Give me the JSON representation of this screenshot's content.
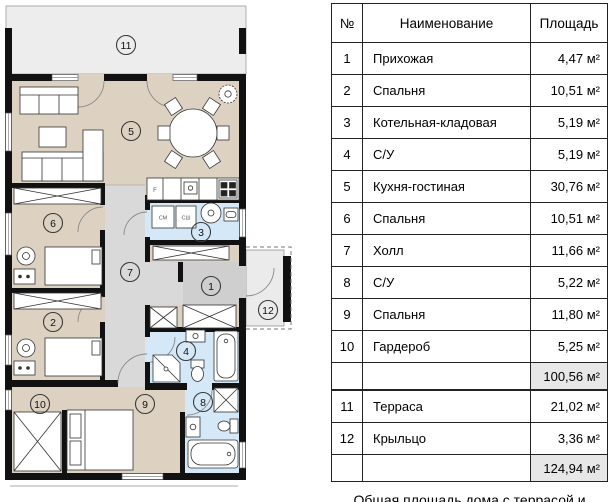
{
  "plan": {
    "room_numbers": {
      "r1": "1",
      "r2": "2",
      "r3": "3",
      "r4": "4",
      "r5": "5",
      "r6": "6",
      "r7": "7",
      "r8": "8",
      "r9": "9",
      "r10": "10",
      "r11": "11",
      "r12": "12"
    },
    "appliance_labels": {
      "fridge": "F",
      "washer": "СМ",
      "dryer": "СШ"
    }
  },
  "table": {
    "headers": {
      "num": "№",
      "name": "Наименование",
      "area": "Площадь"
    },
    "rows": [
      {
        "num": "1",
        "name": "Прихожая",
        "area": "4,47 м²"
      },
      {
        "num": "2",
        "name": "Спальня",
        "area": "10,51 м²"
      },
      {
        "num": "3",
        "name": "Котельная-кладовая",
        "area": "5,19 м²"
      },
      {
        "num": "4",
        "name": "С/У",
        "area": "5,19 м²"
      },
      {
        "num": "5",
        "name": "Кухня-гостиная",
        "area": "30,76 м²"
      },
      {
        "num": "6",
        "name": "Спальня",
        "area": "10,51 м²"
      },
      {
        "num": "7",
        "name": "Холл",
        "area": "11,66 м²"
      },
      {
        "num": "8",
        "name": "С/У",
        "area": "5,22 м²"
      },
      {
        "num": "9",
        "name": "Спальня",
        "area": "11,80 м²"
      },
      {
        "num": "10",
        "name": "Гардероб",
        "area": "5,25 м²"
      },
      {
        "num": "11",
        "name": "Терраса",
        "area": "21,02 м²"
      },
      {
        "num": "12",
        "name": "Крыльцо",
        "area": "3,36 м²"
      }
    ],
    "subtotal_area": "100,56 м²",
    "total_area": "124,94 м²"
  },
  "caption": {
    "text": "Общая площадь дома с террасой и крыльцом: 124,94 м²"
  },
  "colors": {
    "room_beige": "#ddd2c2",
    "bath_blue": "#d4e8f8",
    "hall_gray": "#d9d9d9",
    "entry_gray": "#cfcfcf",
    "terrace_gray": "#ededed",
    "wall_black": "#111111",
    "table_shade": "#e7e7e7"
  }
}
